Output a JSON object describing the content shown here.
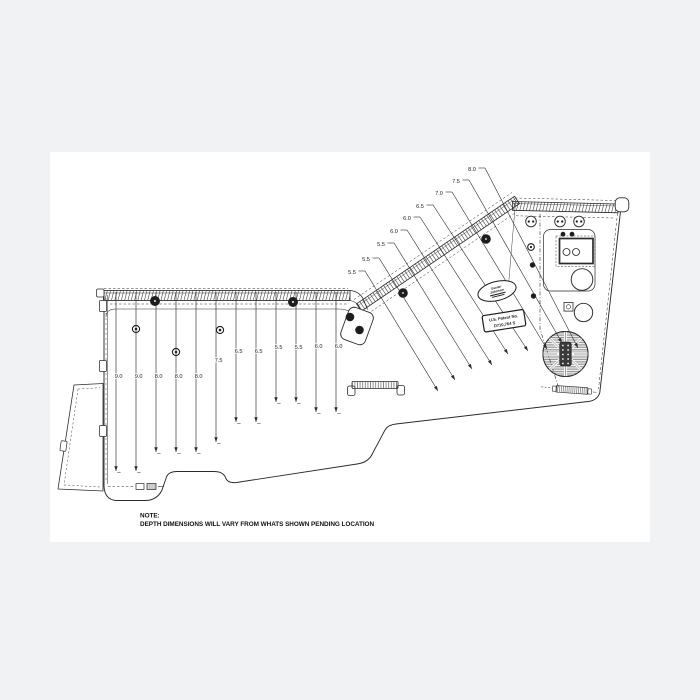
{
  "colors": {
    "background": "#f1f2f4",
    "sheet": "#ffffff",
    "line": "#2b2b2b"
  },
  "note": {
    "title": "NOTE:",
    "body": "DEPTH DIMENSIONS WILL VARY FROM WHATS SHOWN PENDING LOCATION"
  },
  "badges": {
    "logo_oval": {
      "line1": "Gander",
      "line2": "Johnson"
    },
    "patent_box": {
      "line1": "U.S. Patent No.",
      "line2": "D710,764 S"
    }
  },
  "depth_callouts": {
    "left_section": [
      {
        "label": "9.0",
        "x": 116,
        "label_y": 378,
        "tip_y": 471
      },
      {
        "label": "9.0",
        "x": 136,
        "label_y": 378,
        "tip_y": 471
      },
      {
        "label": "8.0",
        "x": 156,
        "label_y": 378,
        "tip_y": 452
      },
      {
        "label": "8.0",
        "x": 176,
        "label_y": 378,
        "tip_y": 452
      },
      {
        "label": "8.0",
        "x": 196,
        "label_y": 378,
        "tip_y": 452
      },
      {
        "label": "7.5",
        "x": 216,
        "label_y": 362,
        "tip_y": 442
      },
      {
        "label": "6.5",
        "x": 236,
        "label_y": 353,
        "tip_y": 422
      },
      {
        "label": "6.5",
        "x": 256,
        "label_y": 353,
        "tip_y": 422
      },
      {
        "label": "5.5",
        "x": 276,
        "label_y": 349,
        "tip_y": 402
      },
      {
        "label": "5.5",
        "x": 296,
        "label_y": 349,
        "tip_y": 402
      },
      {
        "label": "6.0",
        "x": 316,
        "label_y": 348,
        "tip_y": 412
      },
      {
        "label": "6.0",
        "x": 336,
        "label_y": 348,
        "tip_y": 412
      }
    ],
    "transom_section": [
      {
        "label": "5.5",
        "lx": 352,
        "ly": 272,
        "tx": 438,
        "ty": 391
      },
      {
        "label": "5.5",
        "lx": 366,
        "ly": 259,
        "tx": 455,
        "ty": 380
      },
      {
        "label": "5.5",
        "lx": 381,
        "ly": 244,
        "tx": 472,
        "ty": 369
      },
      {
        "label": "6.0",
        "lx": 394,
        "ly": 231,
        "tx": 492,
        "ty": 365
      },
      {
        "label": "6.0",
        "lx": 407,
        "ly": 218,
        "tx": 508,
        "ty": 354
      },
      {
        "label": "6.5",
        "lx": 420,
        "ly": 206,
        "tx": 528,
        "ty": 351
      },
      {
        "label": "7.0",
        "lx": 439,
        "ly": 193,
        "tx": 547,
        "ty": 349
      },
      {
        "label": "7.5",
        "lx": 456,
        "ly": 181,
        "tx": 562,
        "ty": 343
      },
      {
        "label": "8.0",
        "lx": 472,
        "ly": 169,
        "tx": 578,
        "ty": 348
      }
    ]
  }
}
